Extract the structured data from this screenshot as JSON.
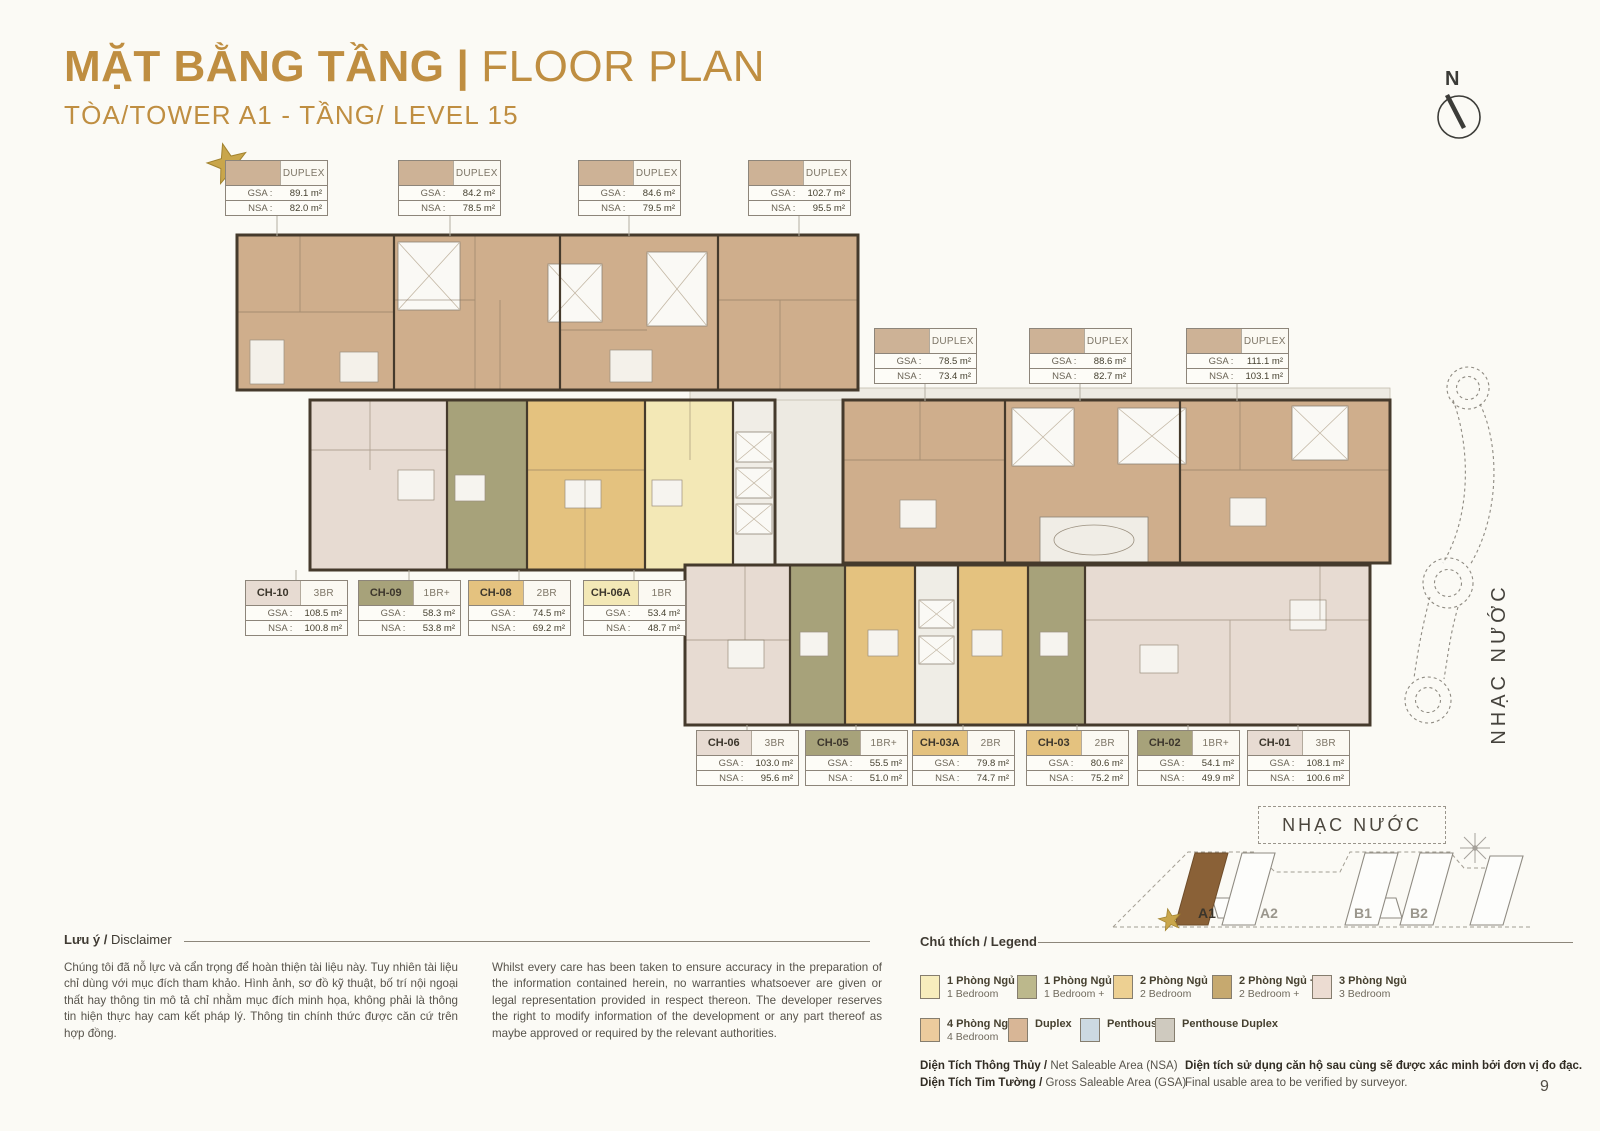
{
  "page": {
    "number": "9"
  },
  "header": {
    "title_vi": "MẶT BẰNG TẦNG",
    "title_sep": "|",
    "title_en": "FLOOR PLAN",
    "subtitle": "TÒA/TOWER A1 - TẦNG/ LEVEL 15"
  },
  "compass": {
    "label": "N"
  },
  "labels": {
    "gsa": "GSA :",
    "nsa": "NSA :"
  },
  "colors": {
    "accent_gold": "#bf8e41",
    "duplex_swatch": "#cdb296",
    "plan_duplex_fill": "#cfae8c",
    "plan_wall": "#453a2c",
    "unit_3br": "#e7dbd2",
    "unit_1br_plus": "#a7a27a",
    "unit_2br": "#e4c27f",
    "unit_1br": "#f3e8b6"
  },
  "callouts": {
    "top_duplex": [
      {
        "type": "DUPLEX",
        "gsa": "89.1 m²",
        "nsa": "82.0 m²"
      },
      {
        "type": "DUPLEX",
        "gsa": "84.2 m²",
        "nsa": "78.5 m²"
      },
      {
        "type": "DUPLEX",
        "gsa": "84.6 m²",
        "nsa": "79.5 m²"
      },
      {
        "type": "DUPLEX",
        "gsa": "102.7 m²",
        "nsa": "95.5 m²"
      }
    ],
    "mid_duplex": [
      {
        "type": "DUPLEX",
        "gsa": "78.5 m²",
        "nsa": "73.4 m²"
      },
      {
        "type": "DUPLEX",
        "gsa": "88.6 m²",
        "nsa": "82.7 m²"
      },
      {
        "type": "DUPLEX",
        "gsa": "111.1 m²",
        "nsa": "103.1 m²"
      }
    ],
    "mid_units": [
      {
        "id": "CH-10",
        "type": "3BR",
        "gsa": "108.5 m²",
        "nsa": "100.8 m²",
        "color": "#e7dbd2"
      },
      {
        "id": "CH-09",
        "type": "1BR+",
        "gsa": "58.3 m²",
        "nsa": "53.8 m²",
        "color": "#a7a27a"
      },
      {
        "id": "CH-08",
        "type": "2BR",
        "gsa": "74.5 m²",
        "nsa": "69.2 m²",
        "color": "#e4c27f"
      },
      {
        "id": "CH-06A",
        "type": "1BR",
        "gsa": "53.4 m²",
        "nsa": "48.7 m²",
        "color": "#f3e8b6"
      }
    ],
    "bottom_units": [
      {
        "id": "CH-06",
        "type": "3BR",
        "gsa": "103.0 m²",
        "nsa": "95.6 m²",
        "color": "#e7dbd2"
      },
      {
        "id": "CH-05",
        "type": "1BR+",
        "gsa": "55.5 m²",
        "nsa": "51.0 m²",
        "color": "#a7a27a"
      },
      {
        "id": "CH-03A",
        "type": "2BR",
        "gsa": "79.8 m²",
        "nsa": "74.7 m²",
        "color": "#e4c27f"
      },
      {
        "id": "CH-03",
        "type": "2BR",
        "gsa": "80.6 m²",
        "nsa": "75.2 m²",
        "color": "#e4c27f"
      },
      {
        "id": "CH-02",
        "type": "1BR+",
        "gsa": "54.1 m²",
        "nsa": "49.9 m²",
        "color": "#a7a27a"
      },
      {
        "id": "CH-01",
        "type": "3BR",
        "gsa": "108.1 m²",
        "nsa": "100.6 m²",
        "color": "#e7dbd2"
      }
    ]
  },
  "water_feature": {
    "label": "NHẠC NƯỚC"
  },
  "site_map": {
    "label": "NHẠC NƯỚC",
    "towers": [
      {
        "name": "A1",
        "highlighted": true
      },
      {
        "name": "A2",
        "highlighted": false
      },
      {
        "name": "B1",
        "highlighted": false
      },
      {
        "name": "B2",
        "highlighted": false
      }
    ]
  },
  "disclaimer": {
    "heading_vi": "Lưu ý /",
    "heading_en": " Disclaimer",
    "text_vi": "Chúng tôi đã nỗ lực và cẩn trọng để hoàn thiện tài liệu này. Tuy nhiên tài liệu chỉ dùng với mục đích tham khảo. Hình ảnh, sơ đồ kỹ thuật, bố trí nội ngoại thất hay thông tin mô tả chỉ nhằm mục đích minh họa, không phải là thông tin hiện thực hay cam kết pháp lý. Thông tin chính thức được căn cứ trên hợp đồng.",
    "text_en": "Whilst every care has been taken to ensure accuracy in the preparation of the information contained herein, no warranties whatsoever are given or legal representation provided in respect thereon. The developer reserves the right to modify information of the development or any part thereof as maybe approved or required by the relevant authorities."
  },
  "legend": {
    "heading": "Chú thích / Legend",
    "items": [
      {
        "vi": "1 Phòng Ngủ",
        "en": "1 Bedroom",
        "color": "#f7edbd"
      },
      {
        "vi": "1 Phòng Ngủ +",
        "en": "1 Bedroom +",
        "color": "#bcb88c"
      },
      {
        "vi": "2 Phòng Ngủ",
        "en": "2 Bedroom",
        "color": "#edd092"
      },
      {
        "vi": "2 Phòng Ngủ +",
        "en": "2 Bedroom +",
        "color": "#c6a96f"
      },
      {
        "vi": "3 Phòng Ngủ",
        "en": "3 Bedroom",
        "color": "#ecdcd2"
      },
      {
        "vi": "4 Phòng Ngủ",
        "en": "4 Bedroom",
        "color": "#eccb9d"
      },
      {
        "vi": "Duplex",
        "en": "",
        "color": "#d8b696"
      },
      {
        "vi": "Penthouse",
        "en": "",
        "color": "#ccd9e1"
      },
      {
        "vi": "Penthouse Duplex",
        "en": "",
        "color": "#cfcabf"
      }
    ]
  },
  "notes": {
    "nsa_bold": "Diện Tích Thông Thủy / ",
    "nsa_rest": "Net Saleable Area (NSA)",
    "gsa_bold": "Diện Tích Tim Tường / ",
    "gsa_rest": "Gross Saleable Area (GSA)",
    "verify_vi": "Diện tích sử dụng căn hộ sau cùng sẽ được xác minh bởi đơn vị đo đạc.",
    "verify_en": "Final usable area to be verified by surveyor."
  }
}
